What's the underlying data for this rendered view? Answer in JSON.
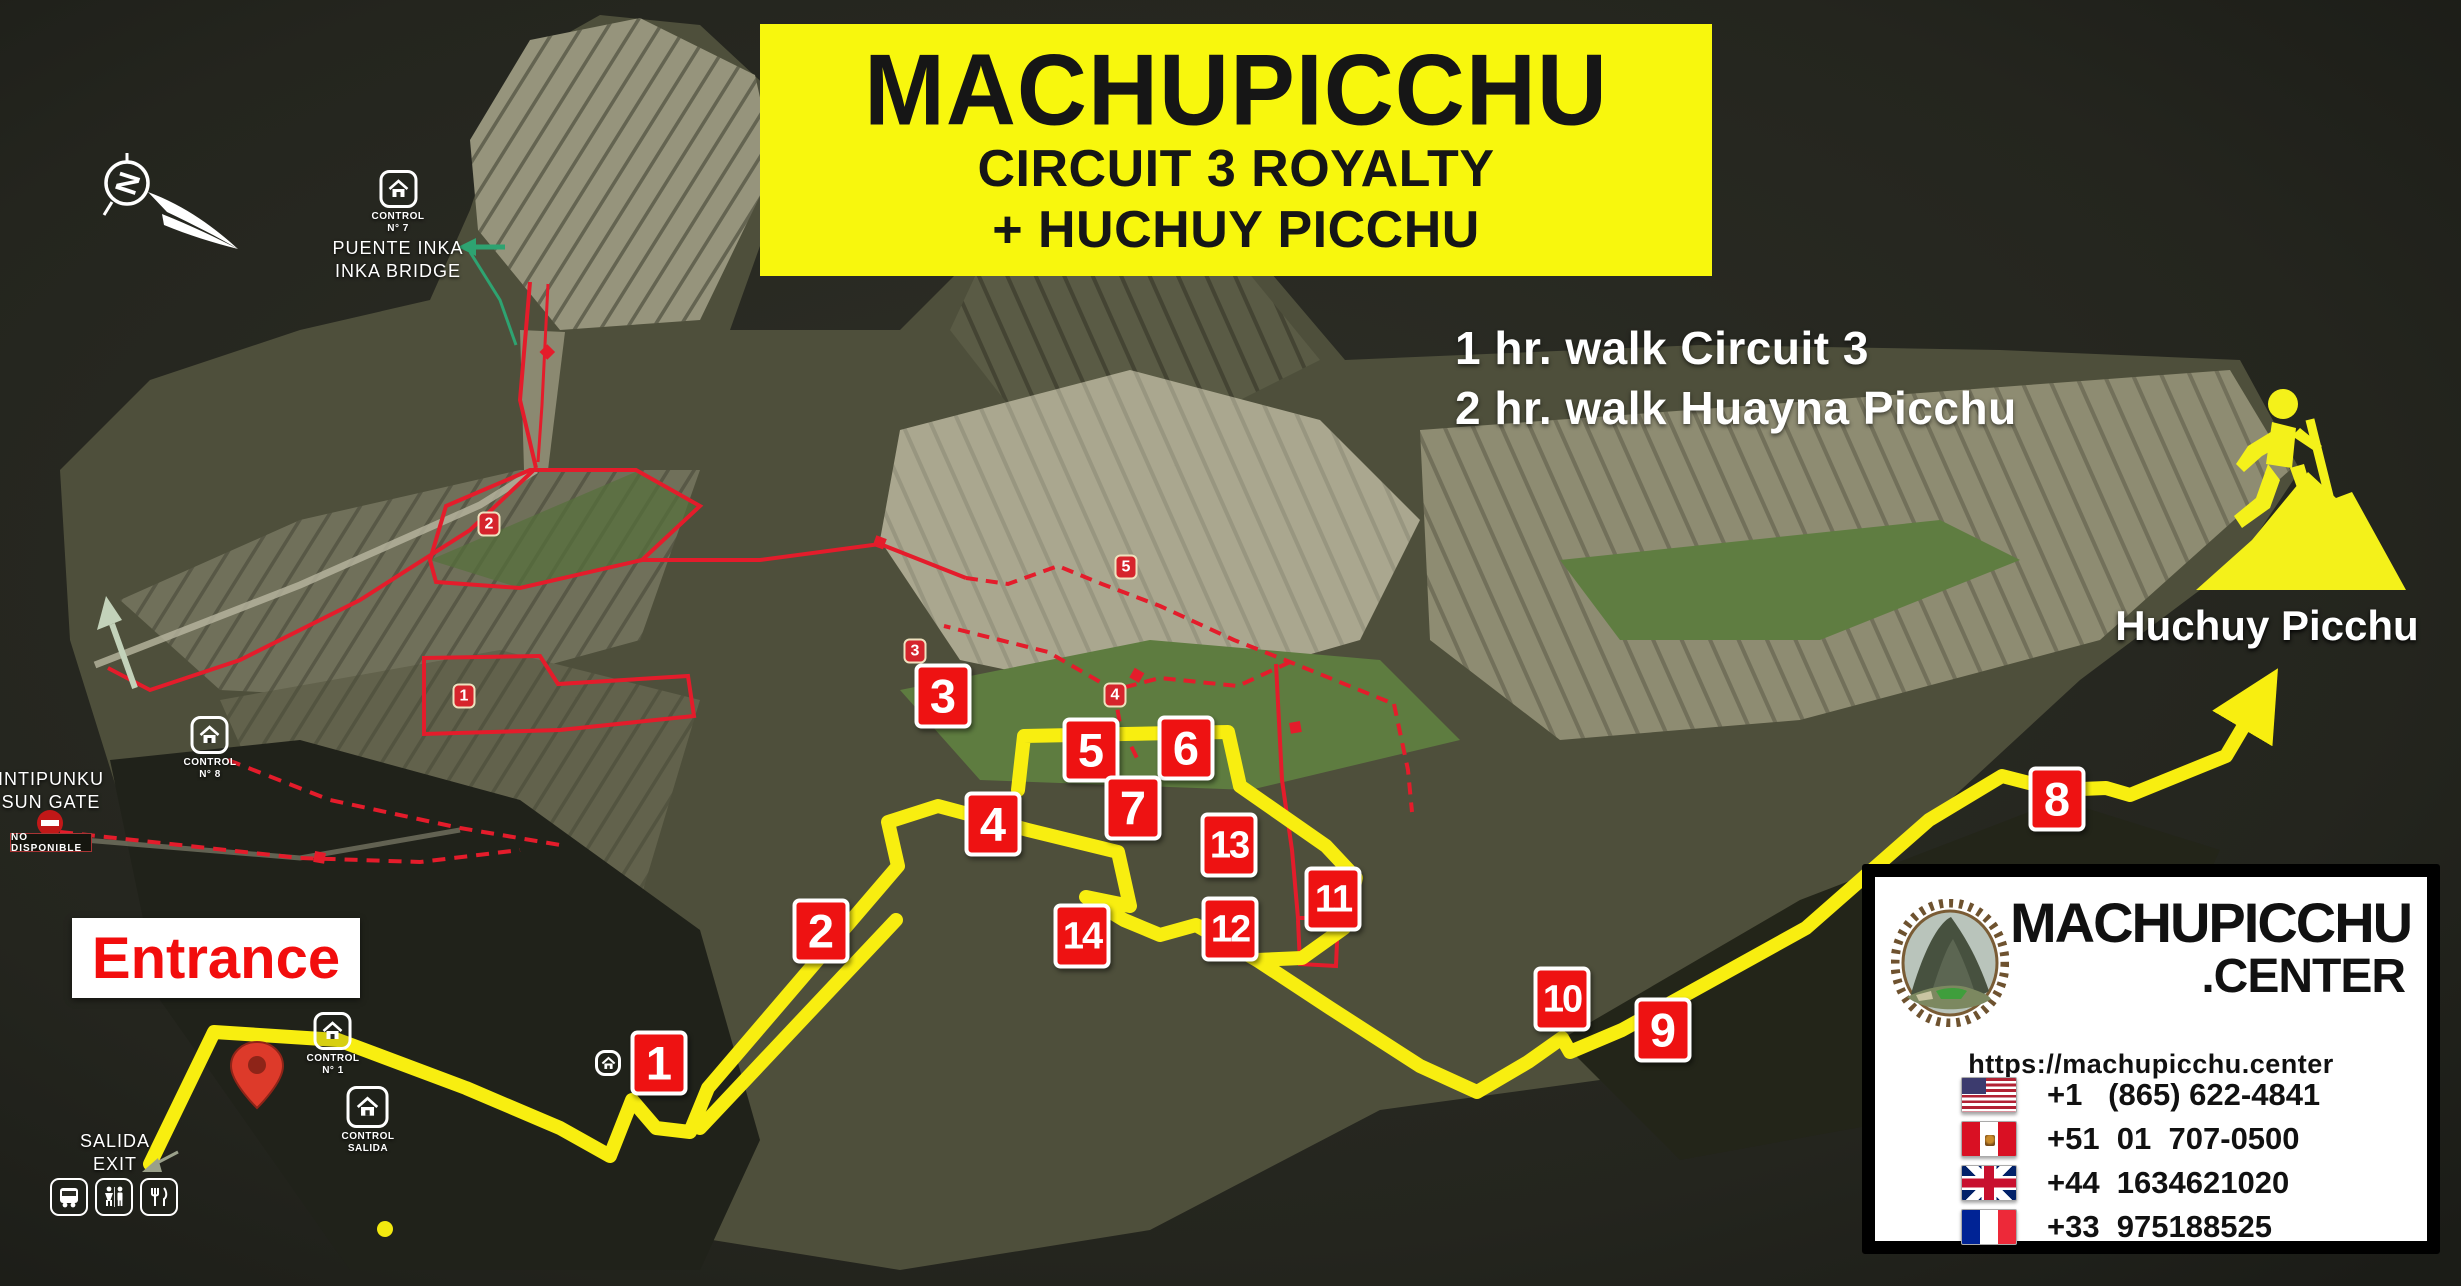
{
  "title": {
    "line1": "MACHUPICCHU",
    "line2": "CIRCUIT 3 ROYALTY",
    "line3": "+ HUCHUY PICCHU"
  },
  "walk_info": {
    "line1": "1 hr. walk Circuit 3",
    "line2": "2 hr. walk Huayna Picchu"
  },
  "compass": {
    "north": "N"
  },
  "huchuy_picchu": {
    "label": "Huchuy Picchu"
  },
  "labels": {
    "puente_inka": {
      "control": "CONTROL",
      "control_no": "N° 7",
      "line1": "PUENTE INKA",
      "line2": "INKA BRIDGE"
    },
    "intipunku": {
      "line1": "INTIPUNKU",
      "line2": "SUN GATE",
      "closed_badge": "NO DISPONIBLE",
      "control": "CONTROL",
      "control_no": "N° 8"
    },
    "entrance": {
      "label": "Entrance"
    },
    "control_1": {
      "control": "CONTROL",
      "control_no": "N° 1"
    },
    "control_salida": {
      "control": "CONTROL",
      "control_no": "SALIDA"
    },
    "salida_exit": {
      "line1": "SALIDA",
      "line2": "EXIT"
    }
  },
  "waypoints": [
    {
      "label": "1"
    },
    {
      "label": "2"
    },
    {
      "label": "3"
    },
    {
      "label": "4"
    },
    {
      "label": "5"
    },
    {
      "label": "6"
    },
    {
      "label": "7"
    },
    {
      "label": "8"
    },
    {
      "label": "9"
    },
    {
      "label": "10"
    },
    {
      "label": "11"
    },
    {
      "label": "12"
    },
    {
      "label": "13"
    },
    {
      "label": "14"
    }
  ],
  "circuit_markers": [
    {
      "label": "1"
    },
    {
      "label": "2"
    },
    {
      "label": "3"
    },
    {
      "label": "4"
    },
    {
      "label": "5"
    }
  ],
  "info_box": {
    "brand_line1": "MACHUPICCHU",
    "brand_line2": ".CENTER",
    "url": "https://machupicchu.center",
    "phones": [
      {
        "country": "usa",
        "number": "+1   (865) 622-4841"
      },
      {
        "country": "peru",
        "number": "+51  01  707-0500"
      },
      {
        "country": "uk",
        "number": "+44  1634621020"
      },
      {
        "country": "france",
        "number": "+33  975188525"
      }
    ]
  },
  "colors": {
    "route_yellow": "#f8ee10",
    "badge_red": "#ee1212",
    "red_trail": "#e41c2b",
    "title_bg": "#f8f70d"
  }
}
